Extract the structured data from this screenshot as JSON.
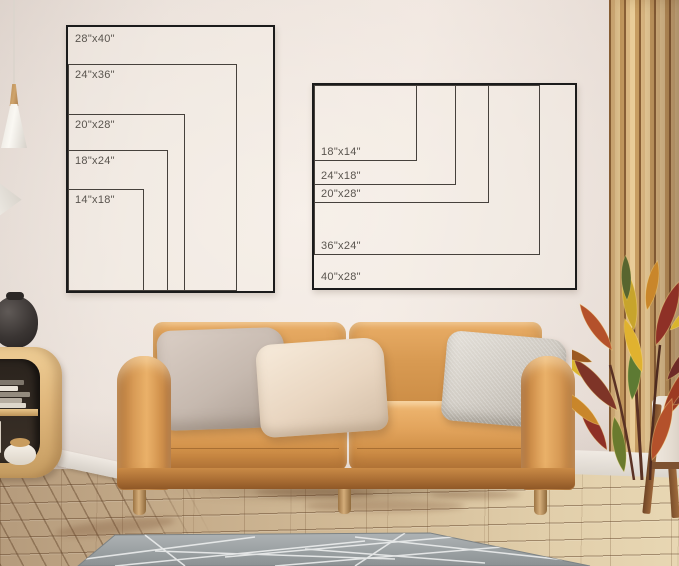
{
  "size_chart_portrait": {
    "sizes": [
      {
        "label": "28\"x40\""
      },
      {
        "label": "24\"x36\""
      },
      {
        "label": "20\"x28\""
      },
      {
        "label": "18\"x24\""
      },
      {
        "label": "14\"x18\""
      }
    ]
  },
  "size_chart_landscape": {
    "sizes": [
      {
        "label": "40\"x28\""
      },
      {
        "label": "36\"x24\""
      },
      {
        "label": "20\"x28\""
      },
      {
        "label": "24\"x18\""
      },
      {
        "label": "18\"x14\""
      }
    ]
  },
  "palette": {
    "wall": "#e9dfd8",
    "chart_frame_line": "#1b1b1b",
    "chart_label_text": "#59544e",
    "sofa_leather": "#d08e4c",
    "wood_furniture": "#d9b478",
    "rug_gray": "#9aa0a2",
    "floor_wood": "#c9b391",
    "plant_red": "#b4512b",
    "plant_yellow": "#d9b42e"
  }
}
